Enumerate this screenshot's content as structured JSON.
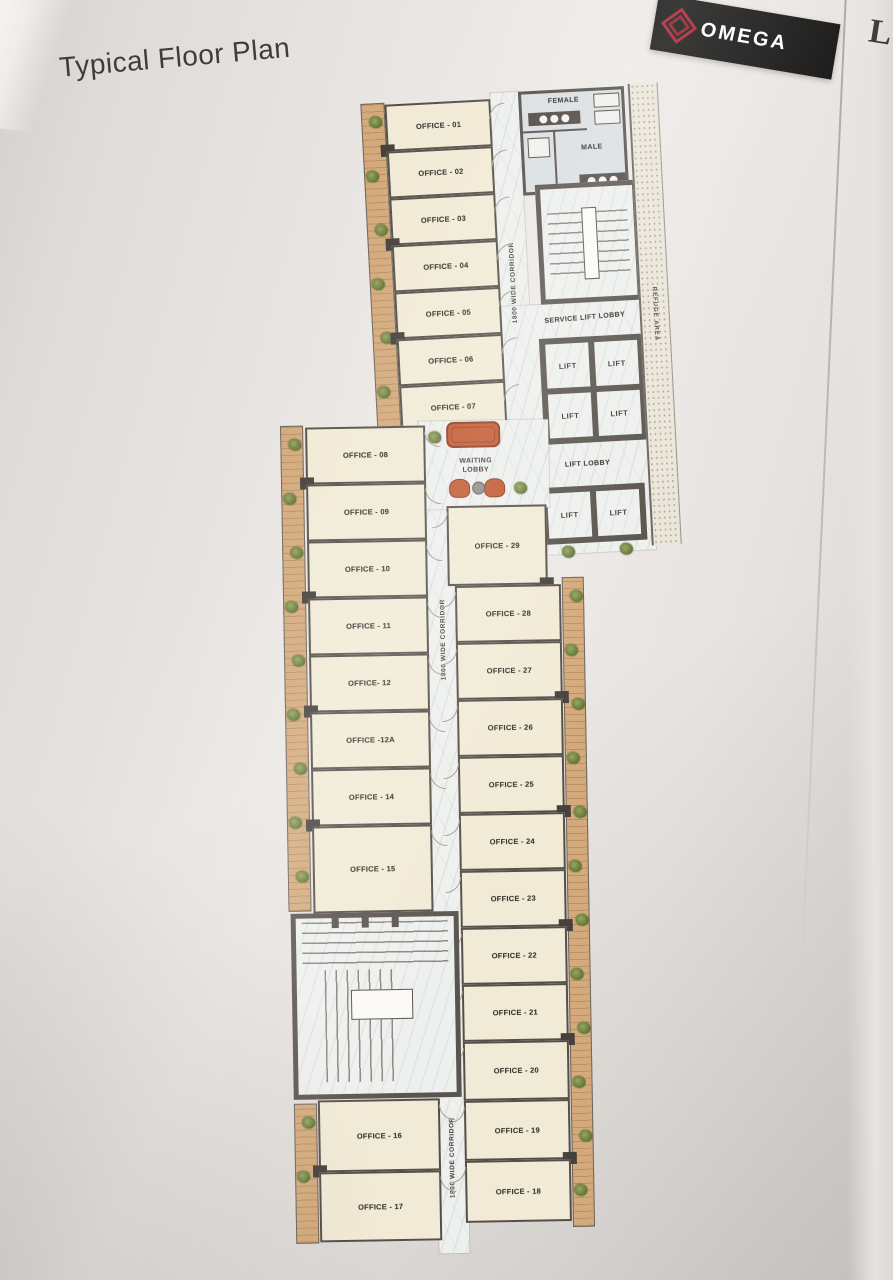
{
  "page": {
    "title": "Typical Floor Plan",
    "edge_letter": "L"
  },
  "brand": {
    "name": "OMEGA",
    "banner_color": "#161514",
    "logo_color": "#a82130"
  },
  "plan": {
    "corridor_label": "1800 WIDE CORRIDOR",
    "upper_offices": [
      "OFFICE - 01",
      "OFFICE - 02",
      "OFFICE - 03",
      "OFFICE - 04",
      "OFFICE - 05",
      "OFFICE - 06",
      "OFFICE - 07"
    ],
    "lower_left_offices": [
      "OFFICE - 08",
      "OFFICE - 09",
      "OFFICE - 10",
      "OFFICE - 11",
      "OFFICE- 12",
      "OFFICE -12A",
      "OFFICE - 14",
      "OFFICE - 15",
      "OFFICE - 16",
      "OFFICE - 17"
    ],
    "lower_right_offices": [
      "OFFICE - 29",
      "OFFICE - 28",
      "OFFICE - 27",
      "OFFICE - 26",
      "OFFICE - 25",
      "OFFICE - 24",
      "OFFICE - 23",
      "OFFICE - 22",
      "OFFICE - 21",
      "OFFICE - 20",
      "OFFICE - 19",
      "OFFICE - 18"
    ],
    "areas": {
      "female": "FEMALE",
      "male": "MALE",
      "service_lift_lobby": "SERVICE LIFT LOBBY",
      "lift": "LIFT",
      "refuge_area": "REFUGE AREA",
      "lift_lobby": "LIFT LOBBY",
      "waiting_lobby_line1": "WAITING",
      "waiting_lobby_line2": "LOBBY"
    },
    "colors": {
      "wall": "#554f49",
      "office_fill": "#f1ead6",
      "corridor_fill": "#eef0ee",
      "toilet_fill": "#dadfe2",
      "planter": "#d4aa7c",
      "plant": "#6d7f3e",
      "sofa": "#c2582f",
      "refuge_fill": "#ebe6da"
    }
  }
}
